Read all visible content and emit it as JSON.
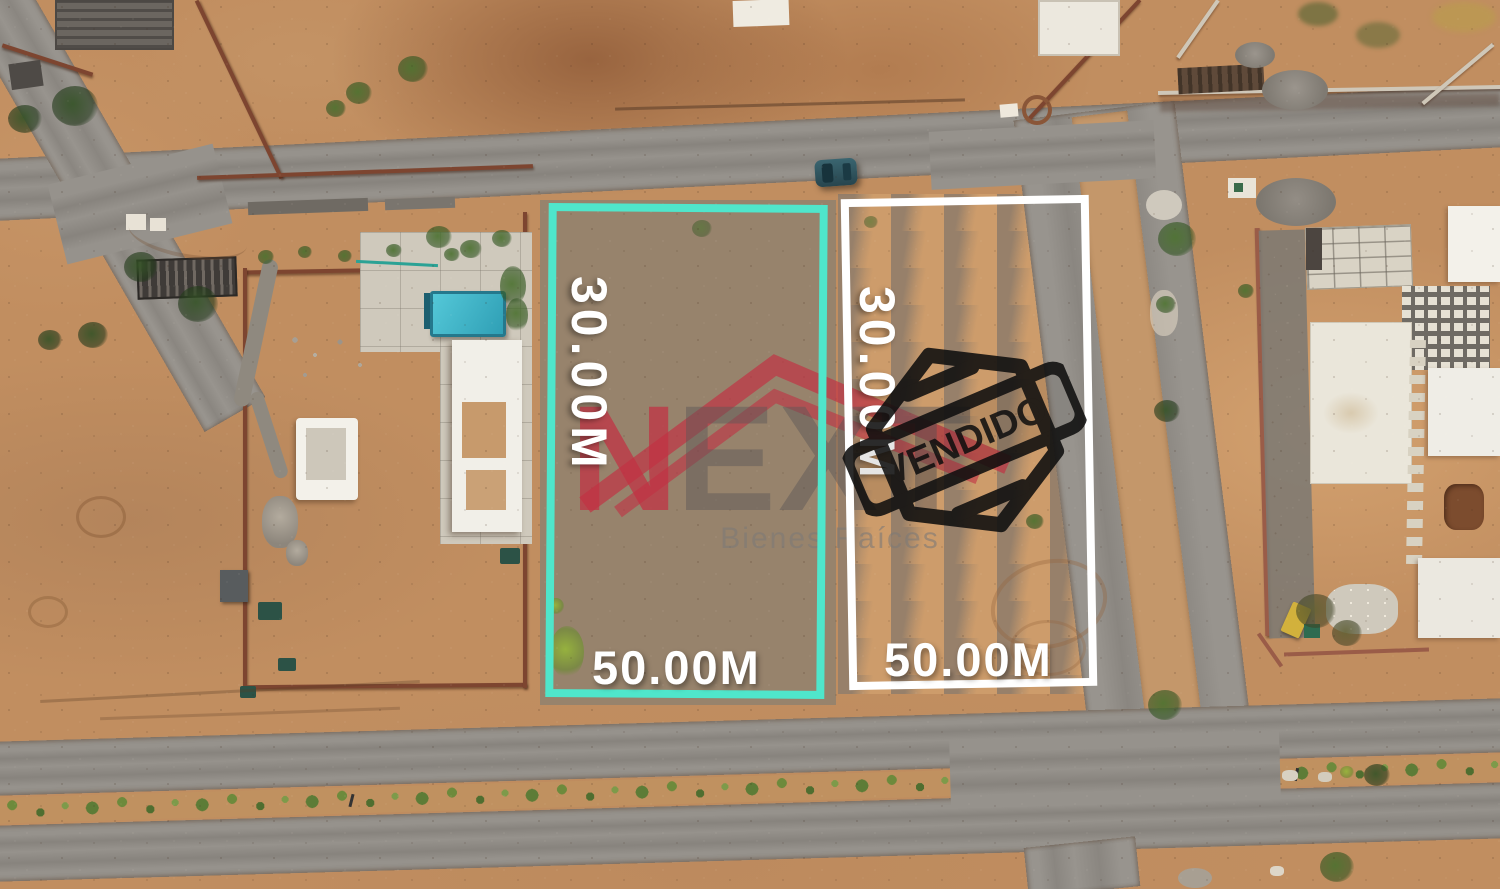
{
  "scene": {
    "description": "Aerial drone photo of two desert residential land lots for sale",
    "car_color": "#315660",
    "pool_color": "#4FC3D4",
    "road_color": "#96928C",
    "dirt_color": "#C18E60"
  },
  "lots": [
    {
      "id": "lot-left",
      "outline_color": "#4FE6CB",
      "depth_label": "30.00M",
      "front_label": "50.00M",
      "status": "available"
    },
    {
      "id": "lot-right",
      "outline_color": "#FFFFFF",
      "depth_label": "30.00M",
      "front_label": "50.00M",
      "status": "sold",
      "stamp": "VENDIDO",
      "stamp_color": "#101010"
    }
  ],
  "watermark": {
    "brand_n": "N",
    "brand_ext": "EXT",
    "tagline": "Bienes Raíces",
    "brand_red": "#C23048",
    "letters_gray": "#6E6A6A"
  }
}
